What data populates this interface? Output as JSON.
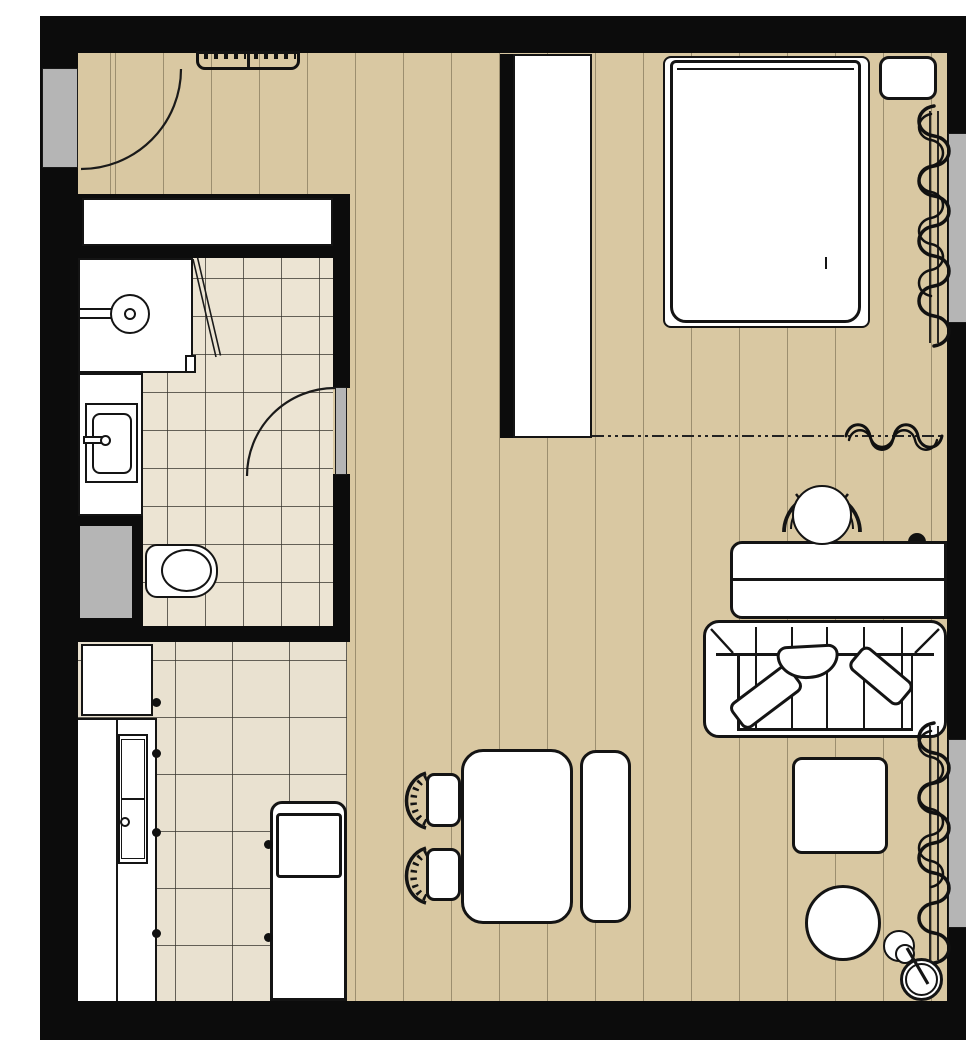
{
  "plan": {
    "label": "Studio apartment floor plan, top view"
  },
  "colors": {
    "wall": "#0c0c0c",
    "wood": "#d9c8a2",
    "plank": "rgba(95,85,60,0.5)",
    "bathtile": "#ece4d3",
    "kitchtile": "#e9e1d0",
    "tileline": "rgba(55,52,45,0.75)",
    "glass": "#b5b5b5",
    "furn": "#ffffff",
    "ink": "#141414"
  },
  "rooms": [
    {
      "id": "hallway",
      "label": "Entry hallway"
    },
    {
      "id": "bathroom",
      "label": "Bathroom"
    },
    {
      "id": "kitchen",
      "label": "Kitchen"
    },
    {
      "id": "living",
      "label": "Living and dining area"
    },
    {
      "id": "sleeping",
      "label": "Sleeping area"
    }
  ],
  "elements": {
    "entry_door": {
      "label": "Entry door with swing arc"
    },
    "radiator": {
      "label": "Radiator"
    },
    "hall_closet": {
      "label": "Built-in hall closet"
    },
    "wardrobe": {
      "label": "Wardrobe partition"
    },
    "bed": {
      "label": "Double bed"
    },
    "nightstand": {
      "label": "Nightstand"
    },
    "bedroom_window": {
      "label": "Window"
    },
    "bedroom_curtain": {
      "label": "Curtain"
    },
    "divider_curtain": {
      "label": "Room-divider curtain on track"
    },
    "desk": {
      "label": "Desk console"
    },
    "desk_chair": {
      "label": "Desk chair"
    },
    "sofa": {
      "label": "Sofa with throw pillows"
    },
    "coffee_table": {
      "label": "Coffee table"
    },
    "pouf": {
      "label": "Pouf"
    },
    "side_table": {
      "label": "Side table"
    },
    "floor_lamp": {
      "label": "Floor lamp"
    },
    "living_window": {
      "label": "Window"
    },
    "living_curtain": {
      "label": "Curtain"
    },
    "dining_table": {
      "label": "Dining table"
    },
    "dining_bench": {
      "label": "Dining bench"
    },
    "dining_chair_1": {
      "label": "Dining chair"
    },
    "dining_chair_2": {
      "label": "Dining chair"
    },
    "fridge": {
      "label": "Refrigerator"
    },
    "kitchen_counter": {
      "label": "Kitchen counter run"
    },
    "cooktop": {
      "label": "Cooktop unit"
    },
    "kitchen_island": {
      "label": "Kitchen unit with sink"
    },
    "bathroom_door": {
      "label": "Bathroom door with swing arc"
    },
    "shower": {
      "label": "Walk-in shower"
    },
    "shower_door": {
      "label": "Glass shower door"
    },
    "vanity": {
      "label": "Vanity counter"
    },
    "washbasin": {
      "label": "Washbasin"
    },
    "toilet": {
      "label": "Toilet"
    },
    "duct": {
      "label": "Service shaft"
    }
  }
}
